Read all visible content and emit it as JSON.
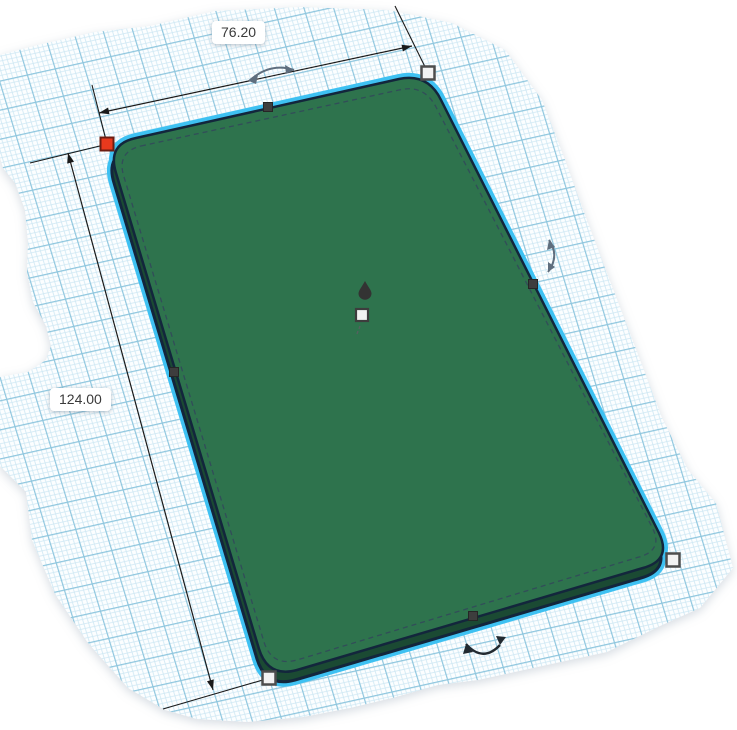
{
  "labels": {
    "width": "76.20",
    "height": "124.00"
  },
  "colors": {
    "workplane_bg": "#FCFEFF",
    "grid_minor": "#CDE7F3",
    "grid_major": "#8EC6DE",
    "selection_highlight": "#3EC1F2",
    "object_top": "#2E734D",
    "object_side": "#1B4A33",
    "object_outline": "#13263C",
    "hidden_edge": "#32475C",
    "dimension_line": "#1A1A1A",
    "handle_red": "#E8391D",
    "handle_red_border": "#6B1D12",
    "handle_white": "#F2F2F2",
    "handle_white_border": "#4D4D4D",
    "handle_mid": "#3D3D3D",
    "rotate_arrow_gray": "#5F6E7E",
    "rotate_arrow_dark": "#222A31",
    "cone_handle": "#333333"
  }
}
